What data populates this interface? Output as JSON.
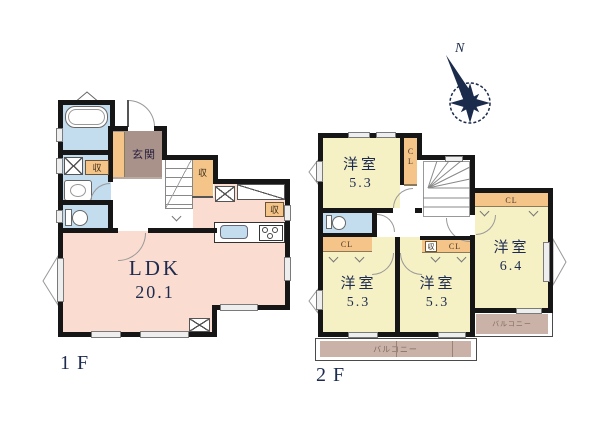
{
  "colors": {
    "wall": "#161616",
    "ldk_pink": "#fadcd0",
    "bedroom_yellow": "#f5f1c4",
    "wet_area_blue": "#c3dcee",
    "closet_orange": "#f4c488",
    "entrance_brown": "#a8928a",
    "balcony_tan": "#cbb2a8",
    "text_navy": "#1e2b50"
  },
  "compass": {
    "north_label": "N"
  },
  "floor1": {
    "floor_label": "1F",
    "ldk": {
      "name": "LDK",
      "area": "20.1"
    },
    "entrance_label": "玄関",
    "storage_label": "収"
  },
  "floor2": {
    "floor_label": "2F",
    "rooms": [
      {
        "name": "洋室",
        "area": "5.3"
      },
      {
        "name": "洋室",
        "area": "5.3"
      },
      {
        "name": "洋室",
        "area": "5.3"
      },
      {
        "name": "洋室",
        "area": "6.4"
      }
    ],
    "closet_label": "CL",
    "storage_label": "収",
    "balcony_label": "バルコニー"
  }
}
